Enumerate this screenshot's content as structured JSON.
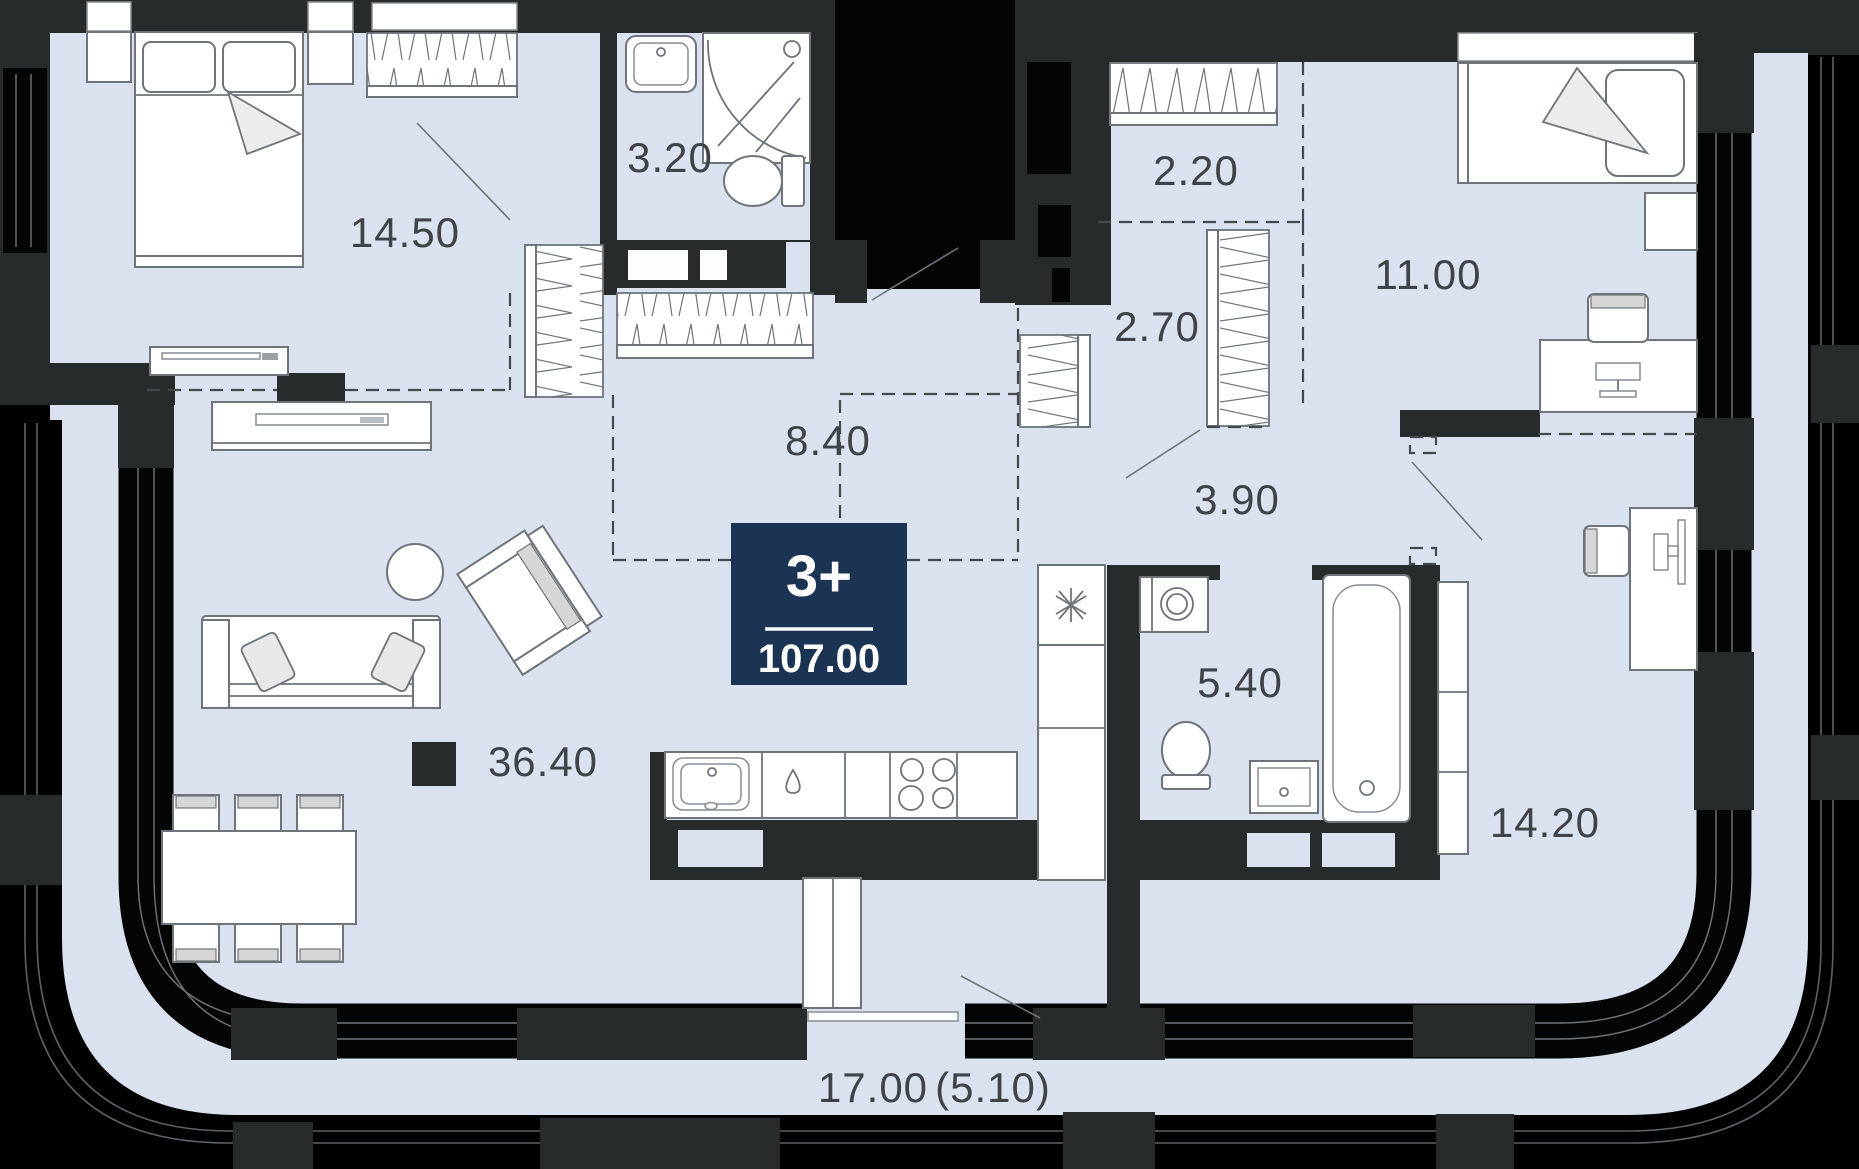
{
  "apartment": {
    "badge": {
      "rooms": "3+",
      "total_area": "107.00"
    },
    "room_areas": [
      {
        "id": "bedroom-main",
        "area": "14.50"
      },
      {
        "id": "bathroom-small",
        "area": "3.20"
      },
      {
        "id": "wardrobe-hall",
        "area": "2.20"
      },
      {
        "id": "bedroom-second",
        "area": "11.00"
      },
      {
        "id": "closet",
        "area": "2.70"
      },
      {
        "id": "hallway",
        "area": "8.40"
      },
      {
        "id": "corridor",
        "area": "3.90"
      },
      {
        "id": "living-kitchen",
        "area": "36.40"
      },
      {
        "id": "bathroom-main",
        "area": "5.40"
      },
      {
        "id": "room-office",
        "area": "14.20"
      }
    ],
    "terrace": {
      "area": "17.00",
      "area_coefficient": "(5.10)"
    },
    "colors": {
      "floor": "#d9e2ee",
      "wall_dark": "#282b2c",
      "wall_window": "#050505",
      "badge_navy": "#1c3453",
      "label_text": "#3f4347",
      "furniture_line": "#6e747a"
    },
    "furniture_icons": [
      "double-bed",
      "single-bed",
      "nightstand",
      "wardrobe",
      "coat-closet",
      "tv-console",
      "sofa",
      "armchair",
      "coffee-table",
      "dining-table",
      "chair",
      "kitchen-counter",
      "kitchen-sink",
      "faucet",
      "stove",
      "fridge",
      "tall-cabinet",
      "washing-machine",
      "toilet",
      "shower-cabin",
      "bathtub",
      "vanity-sink",
      "desk",
      "desk-chair",
      "column"
    ]
  }
}
